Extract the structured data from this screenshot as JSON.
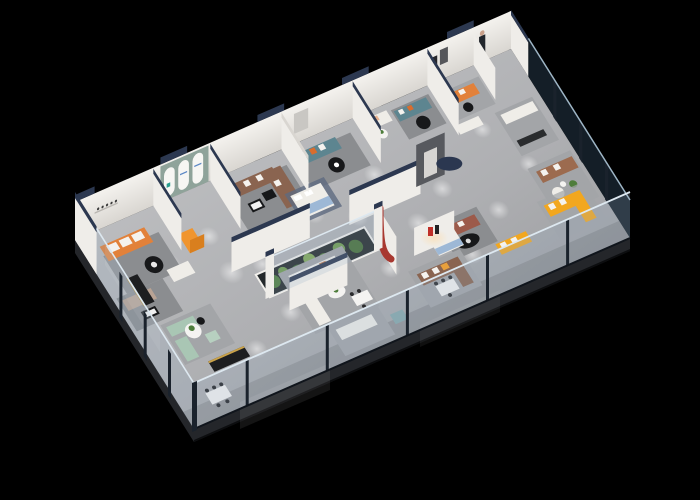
{
  "scene": {
    "title": "3D isometric aerial cutaway render of a modern furniture showroom floor plan on a black background",
    "type": "3d-isometric-floorplan",
    "setting": "furniture showroom interior with glass facade",
    "view": "aerial cutaway perspective",
    "background": "black"
  },
  "palette": {
    "background": "#000000",
    "floor_light": "#c6c7c9",
    "floor_mid": "#aeafb2",
    "floor_dark": "#8f9093",
    "slab_edge": "#24262a",
    "wall": "#efede9",
    "wall_shadow": "#d9d6d1",
    "wall_cap_navy": "#2c3850",
    "sage_wall": "#8fa39a",
    "arch_white": "#f7f6f3",
    "glass_tint": "rgba(150,175,195,0.22)",
    "glass_dark": "rgba(40,60,78,0.5)",
    "glass_frame": "#1a222c",
    "glass_rail": "#dde8f0",
    "rug": "#8b8d90",
    "rug_light": "#a3a5a8",
    "rug_blue": "#5e6a80",
    "sofa_orange": "#e2813a",
    "sofa_brown": "#8a6450",
    "sofa_leather": "#9c6b4f",
    "sofa_teal": "#5d8590",
    "sofa_mint": "#a9c6b4",
    "sofa_yellow": "#f2a71f",
    "sofa_white": "#efede8",
    "sofa_red": "#9c5a4a",
    "sofa_tan": "#b9a394",
    "counter_orange": "#f0952f",
    "counter_orange_dark": "#d97f1e",
    "table_black": "#17181a",
    "table_white": "#f4f3f1",
    "plant_green": "#4e7d3b",
    "terrarium_base": "#23282a",
    "feature_wall": "#57595e",
    "accent_red": "#a83830",
    "logo_red": "#c03028",
    "bed_blue": "#9db8d6",
    "gold_trim": "#c9a24a",
    "navy_table": "#2b3750",
    "cabinet_black": "#1d1e20",
    "pillow_white": "#f4f2ee"
  },
  "vignettes": [
    {
      "label": "orange striped sofa lounge"
    },
    {
      "label": "arched display wall with orange service counter"
    },
    {
      "label": "brown sectional sofa lounge"
    },
    {
      "label": "teal sofa lounge with orange pillows"
    },
    {
      "label": "bedroom display with blue throw"
    },
    {
      "label": "indoor cactus terrarium case"
    },
    {
      "label": "charcoal feature wall with navy round table"
    },
    {
      "label": "red curved accent wall"
    },
    {
      "label": "brand logo arch niche"
    },
    {
      "label": "yellow sofa lounges"
    },
    {
      "label": "glass-walled leather sofa suite"
    },
    {
      "label": "mint green sofa lounge"
    },
    {
      "label": "white sofa and dining displays"
    },
    {
      "label": "greeter figure at rear wall"
    }
  ]
}
